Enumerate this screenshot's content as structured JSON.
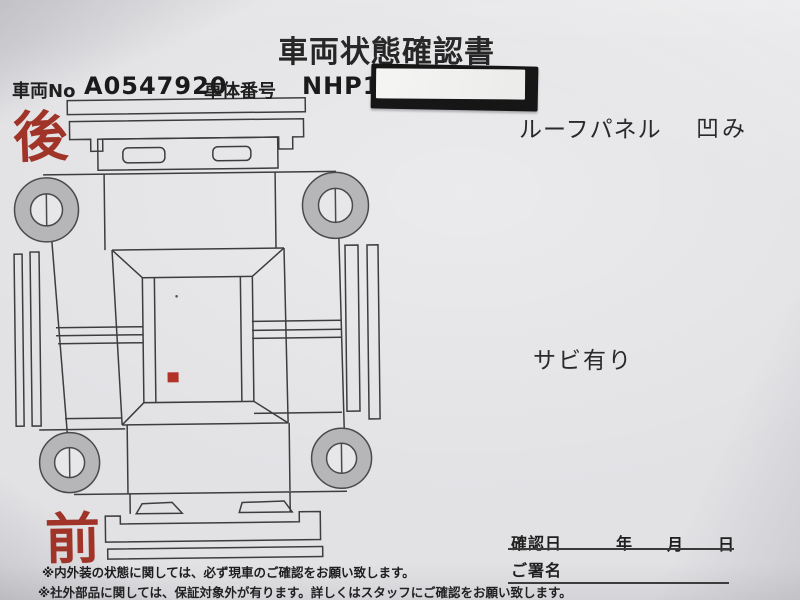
{
  "document": {
    "title": "車両状態確認書",
    "header": {
      "vehicle_no_label": "車両No",
      "vehicle_no_value": "A0547920",
      "body_number_label": "車体番号",
      "body_number_value": "NHP10",
      "body_number_redacted": true
    },
    "orientation": {
      "rear_label": "後",
      "front_label": "前"
    },
    "annotations": {
      "roof_panel_label": "ルーフパネル",
      "roof_panel_condition": "凹み",
      "rust_note": "サビ有り"
    },
    "signature": {
      "confirm_date_label": "確認日",
      "year_label": "年",
      "month_label": "月",
      "day_label": "日",
      "signature_label": "ご署名"
    },
    "footnotes": [
      "※内外装の状態に関しては、必ず現車のご確認をお願い致します。",
      "※社外部品に関しては、保証対象外が有ります。詳しくはスタッフにご確認をお願い致します。"
    ],
    "colors": {
      "accent_red": "#a03428",
      "damage_marker": "#b23226",
      "line": "#3d3d3d",
      "wheel_fill": "#b6b6b8",
      "paper": "#e2e2e5"
    }
  }
}
